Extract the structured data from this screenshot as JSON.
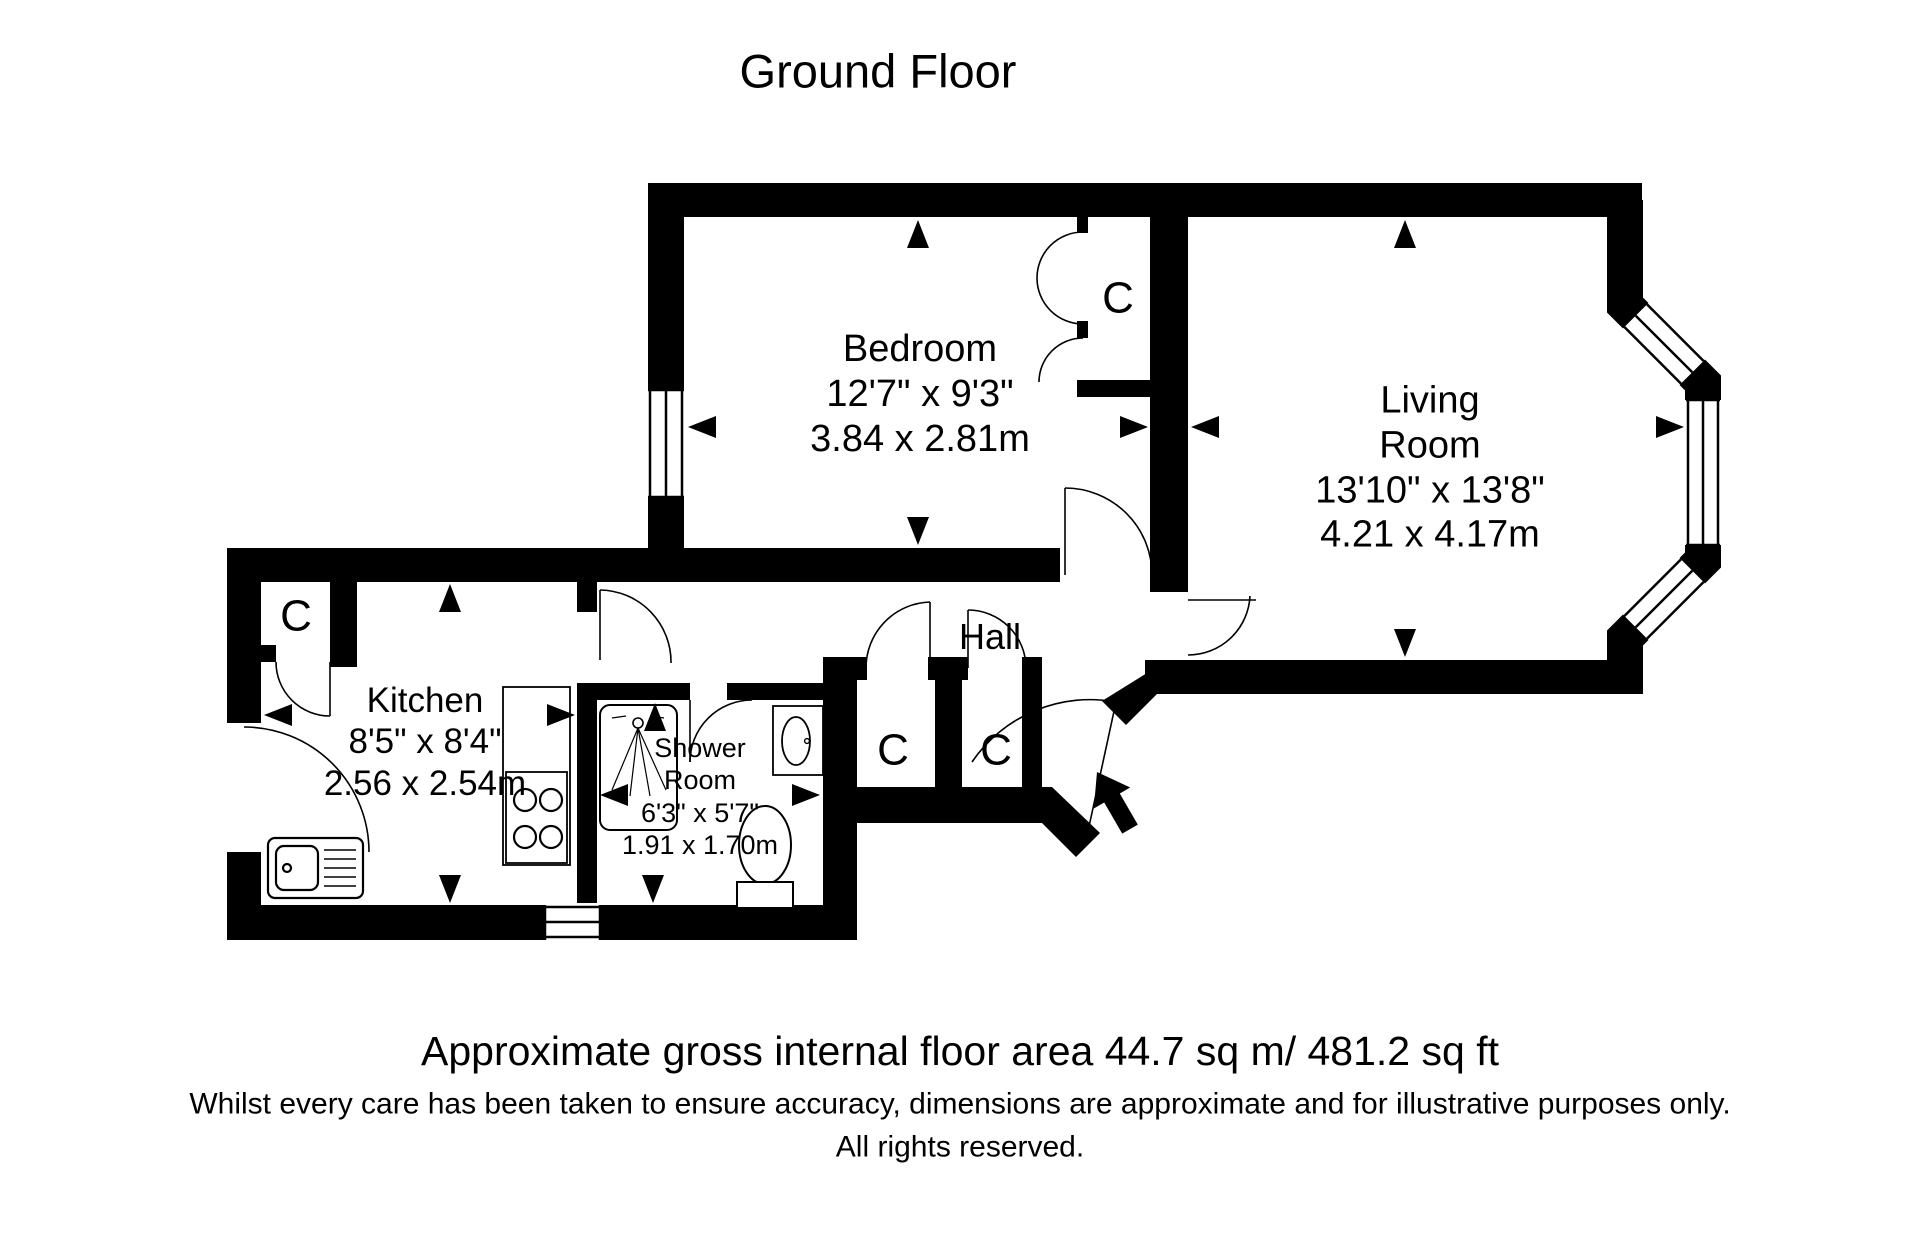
{
  "title": "Ground Floor",
  "rooms": {
    "bedroom": {
      "name": "Bedroom",
      "imperial": "12'7\" x 9'3\"",
      "metric": "3.84 x 2.81m"
    },
    "living_room": {
      "name_line1": "Living",
      "name_line2": "Room",
      "imperial": "13'10\" x 13'8\"",
      "metric": "4.21 x 4.17m"
    },
    "kitchen": {
      "name": "Kitchen",
      "imperial": "8'5\" x 8'4\"",
      "metric": "2.56 x 2.54m"
    },
    "shower_room": {
      "name_line1": "Shower",
      "name_line2": "Room",
      "imperial": "6'3\" x 5'7\"",
      "metric": "1.91 x 1.70m"
    },
    "hall": {
      "name": "Hall"
    }
  },
  "closets": {
    "kitchen": "C",
    "bedroom": "C",
    "hall_left": "C",
    "hall_right": "C"
  },
  "footer": {
    "area": "Approximate gross internal floor area 44.7 sq m/ 481.2 sq ft",
    "disclaimer": "Whilst every care has been taken to ensure accuracy, dimensions are approximate and for illustrative purposes only.",
    "rights": "All rights reserved."
  },
  "colors": {
    "wall": "#000000",
    "background": "#ffffff"
  }
}
